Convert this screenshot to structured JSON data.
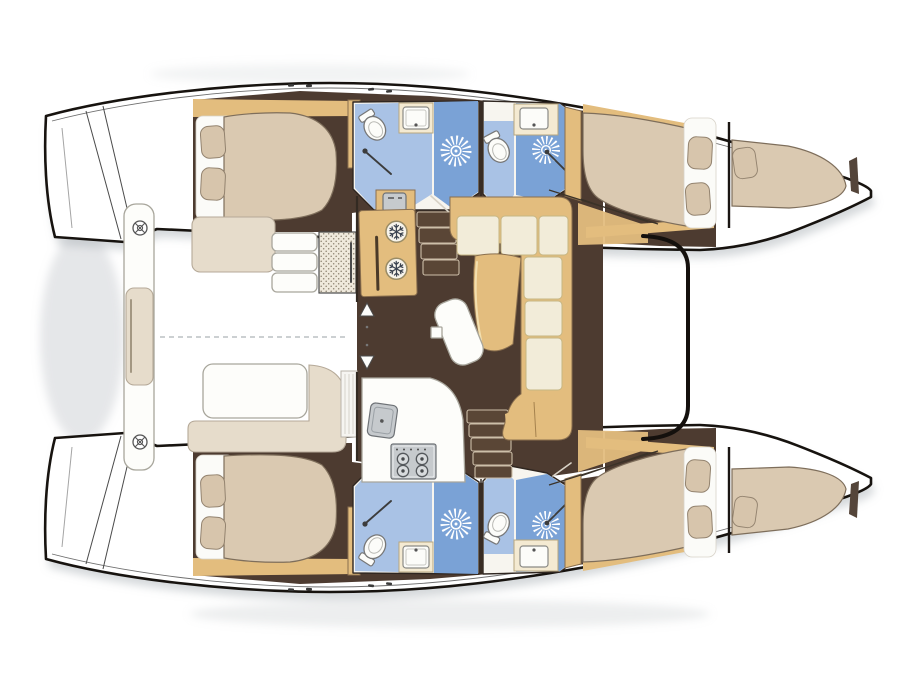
{
  "title": "Catamaran interior layout floor plan (top view, bows to the right): two hulls with cabins and bathrooms, central saloon with galley, aft cockpit",
  "colors": {
    "outline": "#17130f",
    "wall": "#2f2620",
    "floor": "#4d3b30",
    "wood": "#e3bd7e",
    "woodEdge": "#8a6f4e",
    "cushion": "#f2ecd9",
    "cushionTrim": "#c6b683",
    "bed": "#dac9b1",
    "bedEdge": "#7e6e5b",
    "pillow": "#d7c5ac",
    "pillowEdge": "#93836f",
    "bathLight": "#a9c2e5",
    "bathMid": "#7aa2d6",
    "fixture": "#fcfcf9",
    "appliance": "#c6cacd",
    "applianceEdge": "#6e7276",
    "counter": "#f4ead2",
    "counterEdge": "#b7a77f",
    "bench": "#e6dccb",
    "benchEdge": "#b5a998",
    "stair": "#5a4636",
    "stairEdge": "#cdbfa9",
    "shadow": "#9199a0",
    "rays": "#ffffff",
    "snowflake": "#3b4350"
  },
  "legend": {
    "hulls": [
      {
        "side": "port",
        "position": "top",
        "spaces": [
          "aft double cabin with two pillows",
          "aft head with toilet, basin and shower",
          "forward head with toilet, basin and shower",
          "forward double cabin with two pillows",
          "bow berth with pillow"
        ]
      },
      {
        "side": "starboard",
        "position": "bottom",
        "spaces": [
          "aft double cabin with two pillows",
          "aft head with toilet, basin and shower",
          "forward head with toilet, basin and shower",
          "forward double cabin with two pillows",
          "bow berth with pillow"
        ]
      }
    ],
    "saloon": [
      "galley top cabinet with sink",
      "double fridge with snowflake symbols",
      "galley counter with sink",
      "four-burner stove",
      "companionway stairs to port hull",
      "companionway stairs to starboard hull",
      "U-shaped settee",
      "dining table",
      "curved white bench",
      "entry up-down arrows"
    ],
    "cockpit": [
      "aft platform",
      "two round deck hatches",
      "aft bench cushion",
      "side bench seat",
      "cockpit table",
      "L-shaped bench",
      "boarding steps",
      "woven storage locker",
      "folding sliding door",
      "dashed centerline"
    ],
    "counts": {
      "cabins": 4,
      "heads": 4,
      "showers": 4,
      "toilets": 4,
      "wash_basins": 4,
      "bow_berths": 2,
      "fridge_drawers": 2,
      "stove_burners": 4,
      "deck_hatches": 2
    }
  }
}
